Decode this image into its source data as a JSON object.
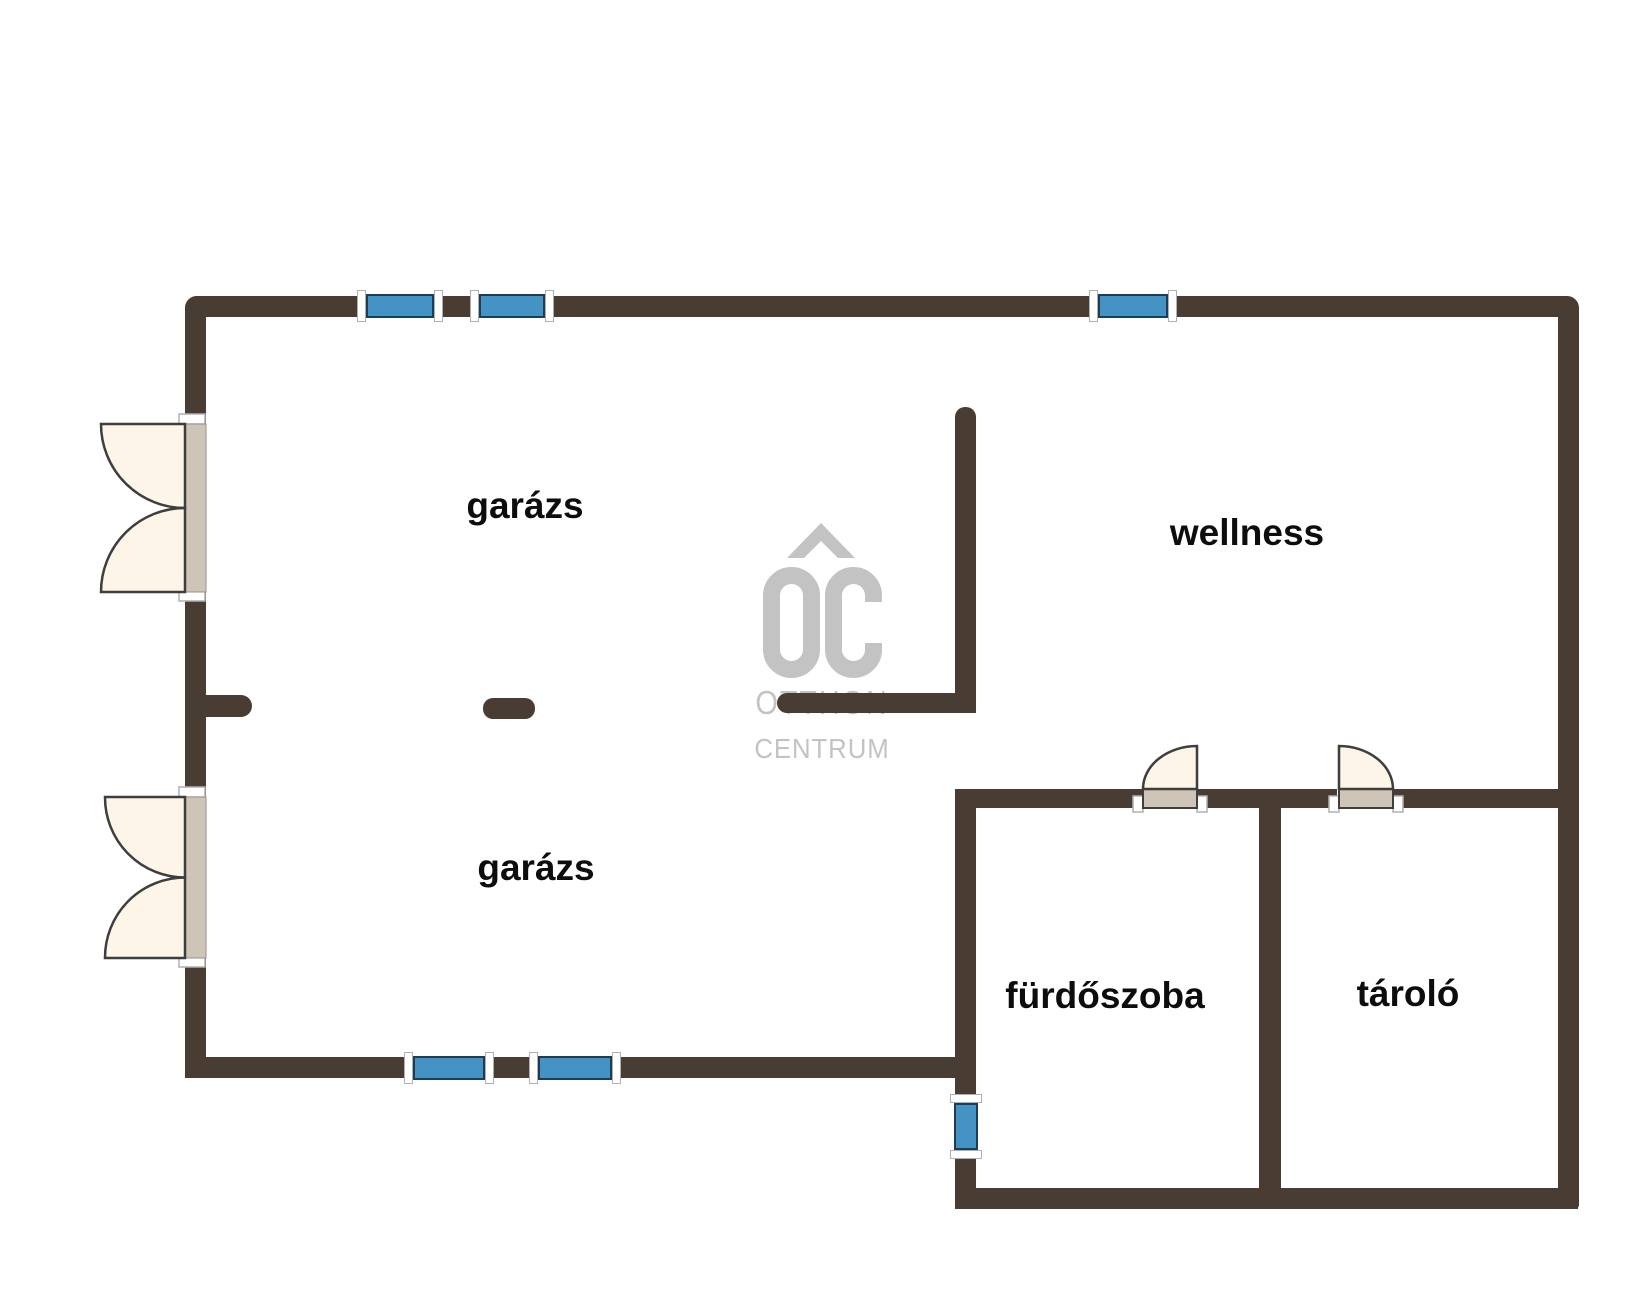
{
  "floorplan": {
    "rooms": [
      {
        "id": "garage-top",
        "label": "garázs"
      },
      {
        "id": "garage-bottom",
        "label": "garázs"
      },
      {
        "id": "wellness",
        "label": "wellness"
      },
      {
        "id": "bathroom",
        "label": "fürdőszoba"
      },
      {
        "id": "storage",
        "label": "tároló"
      }
    ],
    "watermark": {
      "monogram": "OC",
      "line1": "OTTHON",
      "line2": "CENTRUM"
    },
    "colors": {
      "wall": "#493d33",
      "window_glass": "#4493c4",
      "window_frame": "#1f3c55",
      "window_cap": "#ffffff",
      "door_leaf": "#fcf5e8",
      "door_threshold": "#cec4b7",
      "door_outline": "#3e3e3c",
      "watermark": "#c3c3c3",
      "label_text": "#0d0d0d",
      "bg": "#ffffff"
    }
  }
}
